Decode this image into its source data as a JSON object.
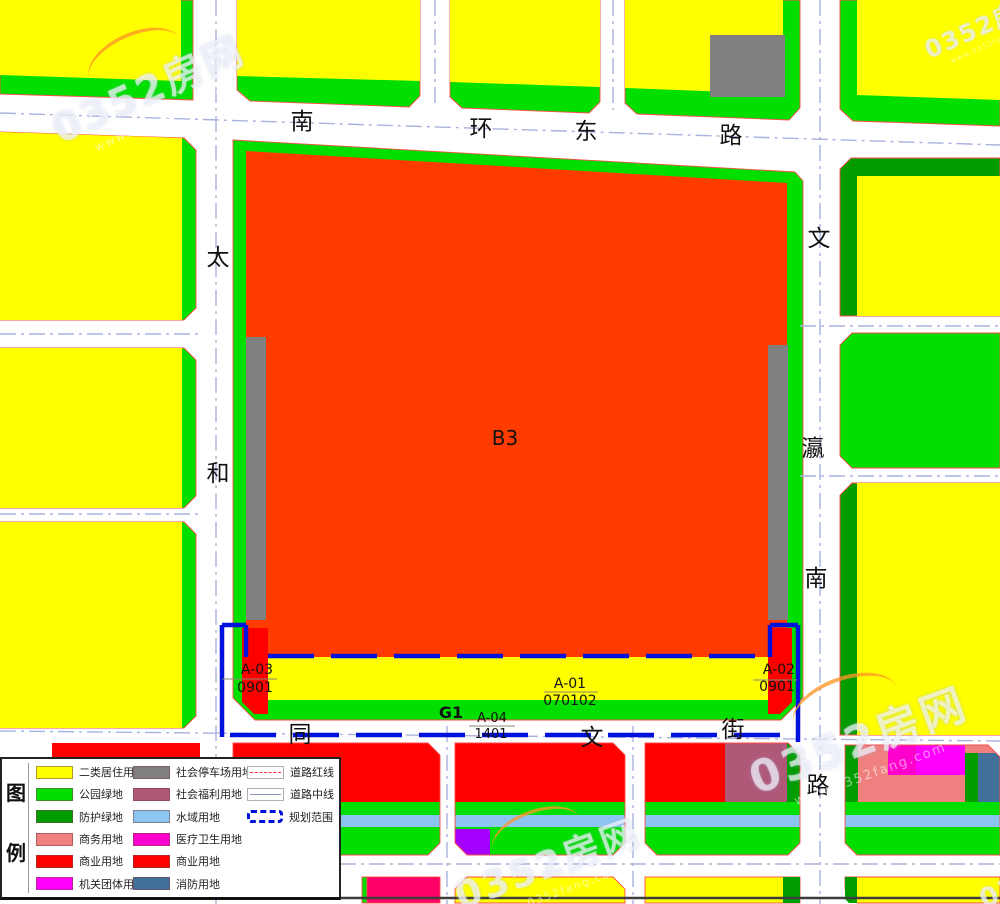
{
  "map": {
    "colors": {
      "yellow": "#FFFF00",
      "green": "#00DF00",
      "dgreen": "#009C00",
      "orange": "#FF3B00",
      "red": "#FF0000",
      "gray": "#808080",
      "water": "#8CC6F0",
      "salmon": "#F08080",
      "mauve": "#B05878",
      "magenta": "#FF00FF",
      "magenta2": "#FF00CD",
      "pink": "#FF0066",
      "purple": "#A500FF",
      "steel": "#41709B",
      "road": "#A9B2DE",
      "boundary": "#0010DD",
      "outline": "#FF4A4A"
    },
    "labels": {
      "b3": "B3",
      "g1": "G1",
      "a03_1": "A-03",
      "a03_2": "0901",
      "a01_1": "A-01",
      "a01_2": "070102",
      "a02_1": "A-02",
      "a02_2": "0901",
      "a04_1": "A-04",
      "a04_2": "1401"
    },
    "roads": {
      "top": [
        "南",
        "环",
        "东",
        "路"
      ],
      "left": [
        "太",
        "和"
      ],
      "right": [
        "文",
        "瀛",
        "南",
        "路"
      ],
      "bottom": [
        "同",
        "文",
        "街"
      ]
    }
  },
  "legend": {
    "title": [
      "图",
      "例"
    ],
    "items": [
      {
        "label": "二类居住用地",
        "color": "#FFFF00"
      },
      {
        "label": "公园绿地",
        "color": "#00DF00"
      },
      {
        "label": "防护绿地",
        "color": "#009C00"
      },
      {
        "label": "商务用地",
        "color": "#F08080"
      },
      {
        "label": "商业用地",
        "color": "#FF0000"
      },
      {
        "label": "机关团体用地",
        "color": "#FF00FF"
      },
      {
        "label": "社会停车场用地",
        "color": "#808080"
      },
      {
        "label": "社会福利用地",
        "color": "#B05878"
      },
      {
        "label": "水域用地",
        "color": "#8CC6F0"
      },
      {
        "label": "医疗卫生用地",
        "color": "#FF00CD"
      },
      {
        "label": "商业用地",
        "color": "#FF0000"
      },
      {
        "label": "消防用地",
        "color": "#41709B"
      }
    ],
    "line_items": [
      {
        "label": "道路红线",
        "type": "red-dash",
        "color": "#FF3333"
      },
      {
        "label": "道路中线",
        "type": "center-line",
        "color": "#8899BB"
      },
      {
        "label": "规划范围",
        "type": "boundary",
        "color": "#0010DD"
      }
    ]
  },
  "watermark": {
    "brand": "0352房网",
    "url": "www.0352fang.com"
  }
}
